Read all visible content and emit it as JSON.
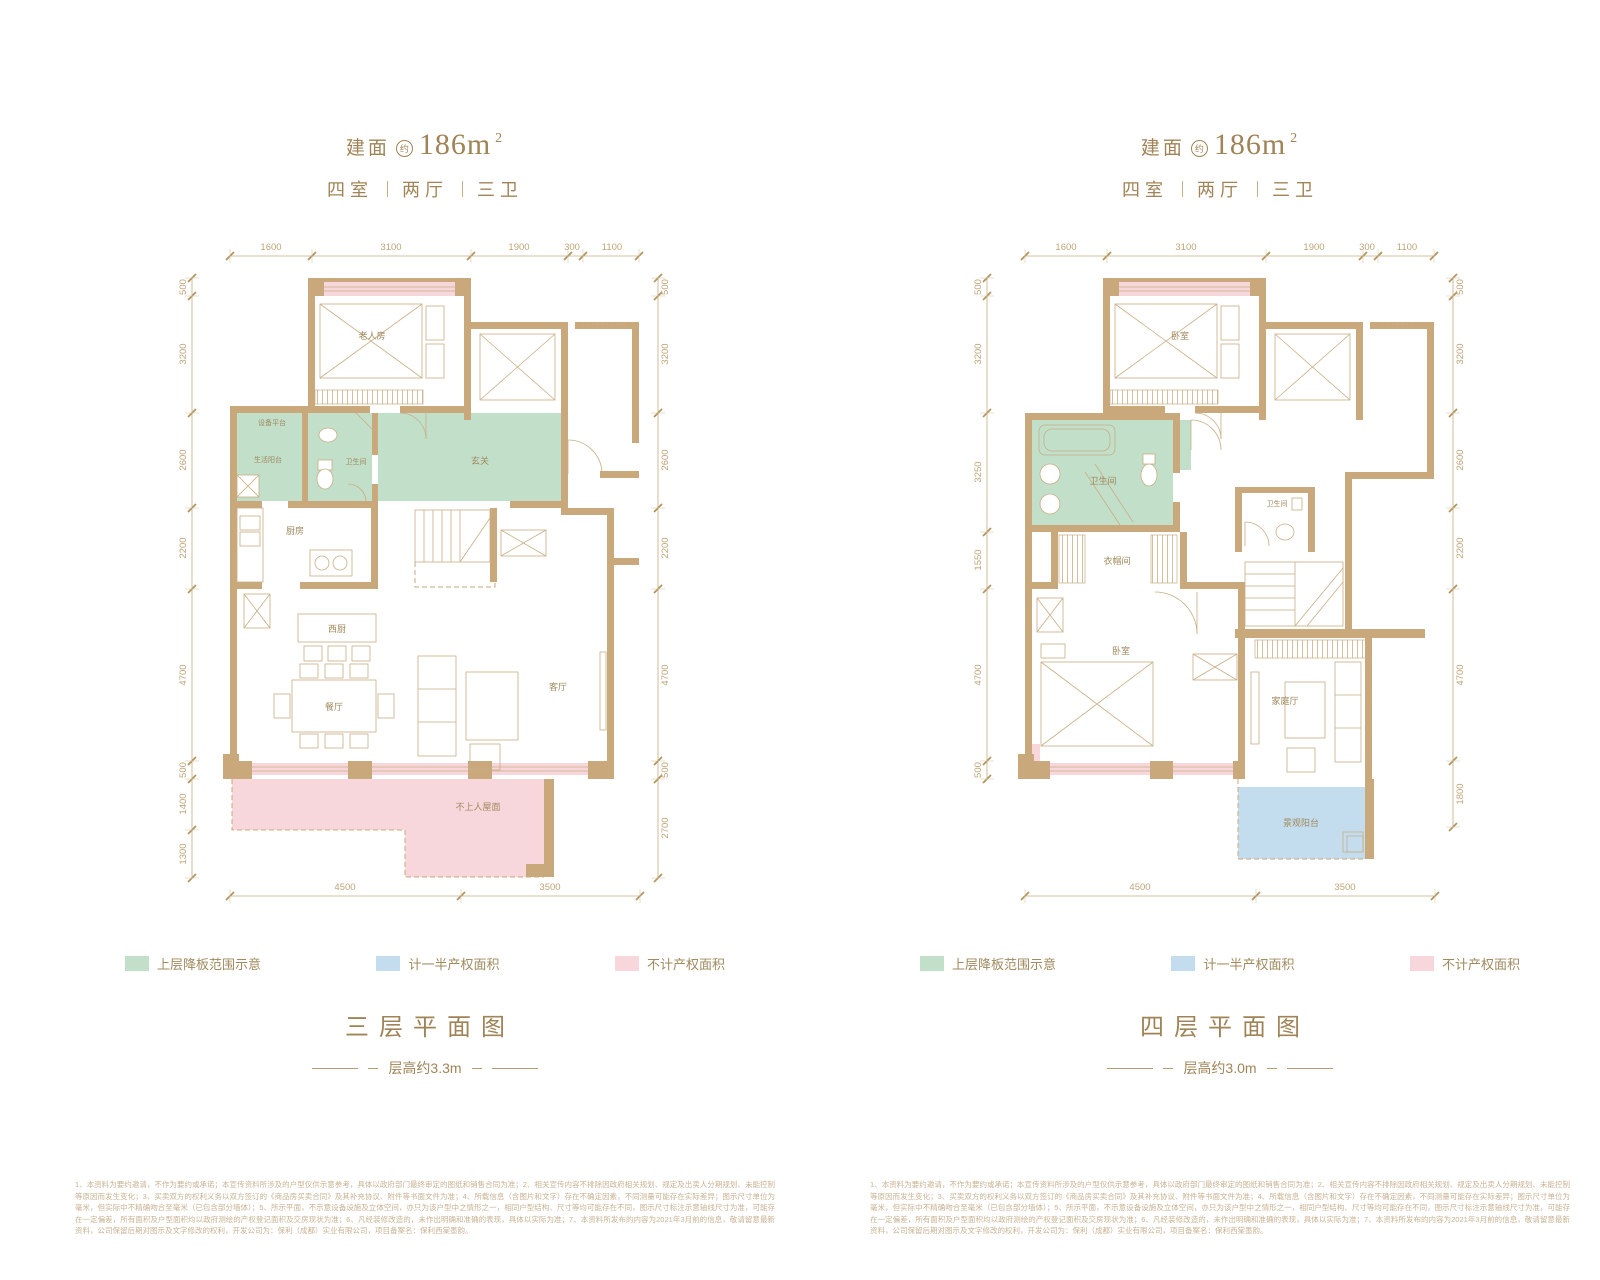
{
  "colors": {
    "wall": "#c9a87c",
    "green_fill": "#c2dfca",
    "pink_fill": "#f8d7dc",
    "blue_fill": "#c4ddee",
    "text_gold": "#a08457",
    "dim_text": "#c0a478"
  },
  "header": {
    "area_prefix": "建面",
    "area_circle": "约",
    "area_value": "186m",
    "area_sup": "2",
    "rooms": "四室",
    "halls": "两厅",
    "baths": "三卫"
  },
  "legend": [
    {
      "name": "upper-slab-drop",
      "label": "上层降板范围示意",
      "color": "#c2dfca"
    },
    {
      "name": "half-property-area",
      "label": "计一半产权面积",
      "color": "#c4ddee"
    },
    {
      "name": "no-property-area",
      "label": "不计产权面积",
      "color": "#f8d7dc"
    }
  ],
  "plans": [
    {
      "caption": "三层平面图",
      "height_note": "层高约3.3m",
      "dims_top": [
        "1600",
        "3100",
        "1900",
        "300",
        "1100"
      ],
      "dims_left": [
        "500",
        "3200",
        "2600",
        "2200",
        "4700",
        "500",
        "1400",
        "1300"
      ],
      "dims_right": [
        "500",
        "3200",
        "2600",
        "2200",
        "4700",
        "500",
        "2700"
      ],
      "dims_bottom": [
        "4500",
        "3500"
      ],
      "rooms": {
        "elder_room": "老人房",
        "equip_platform": "设备平台",
        "bath": "卫生间",
        "life_balcony": "生活阳台",
        "kitchen": "厨房",
        "foyer": "玄关",
        "west_kitchen": "西厨",
        "dining": "餐厅",
        "living": "客厅",
        "roof": "不上人屋面"
      }
    },
    {
      "caption": "四层平面图",
      "height_note": "层高约3.0m",
      "dims_top": [
        "1600",
        "3100",
        "1900",
        "300",
        "1100"
      ],
      "dims_left": [
        "500",
        "3200",
        "3250",
        "1550",
        "4700",
        "500"
      ],
      "dims_right": [
        "500",
        "3200",
        "2600",
        "2200",
        "4700",
        "1800"
      ],
      "dims_bottom": [
        "4500",
        "3500"
      ],
      "rooms": {
        "bedroom_top": "卧室",
        "bath_main": "卫生间",
        "bath_small": "卫生间",
        "cloakroom": "衣帽间",
        "bedroom": "卧室",
        "family_hall": "家庭厅",
        "view_balcony": "景观阳台"
      }
    }
  ],
  "disclaimer": "1、本资料为要约邀请，不作为要约或承诺；本宣传资料所涉及的户型仅供示意参考，具体以政府部门最终审定的图纸和销售合同为准；2、相关宣传内容不排除因政府相关规划、规定及出卖人分期规划、未能控制等原因而发生变化；3、买卖双方的权利义务以双方签订的《商品房买卖合同》及其补充协议、附件等书面文件为准；4、所载信息（含图片和文字）存在不确定因素，不同测量可能存在实际差异；图示尺寸单位为毫米，但实际中不精确吻合至毫米（已包含部分墙体）；5、所示平面，不示意设备设施及立体空间，亦只为该户型中之情形之一，相同户型结构、尺寸等均可能存在不同，图示尺寸标注示意轴线尺寸为准，可能存在一定偏差，所有面积及户型面积均以政府测绘的产权登记面积及交房现状为准；6、凡经装修改造的，未作出明确和准确的表现，具体以实际为准；7、本资料所发布的内容为2021年3月前的信息，敬请留意最新资料，公司保留后期对图示及文字修改的权利，开发公司为：保利（成都）实业有限公司，项目备案名：保利西棠墨韵。"
}
